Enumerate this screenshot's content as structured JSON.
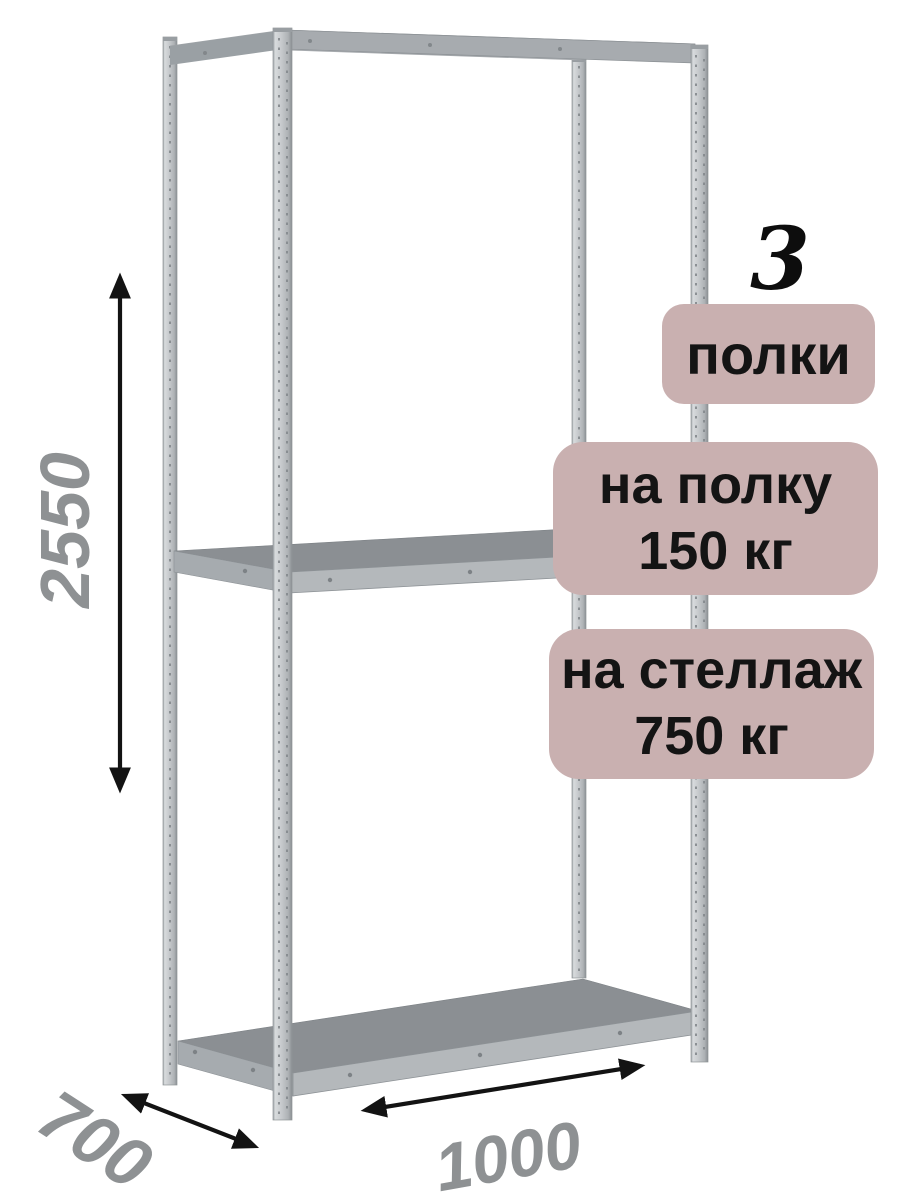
{
  "product": {
    "description": "metal-boltless-shelving-rack",
    "shelves_shown": 3
  },
  "badges": {
    "shelf_count": {
      "number": "3",
      "label": "полки"
    },
    "per_shelf": {
      "line1": "на полку",
      "line2": "150 кг"
    },
    "per_rack": {
      "line1": "на стеллаж",
      "line2": "750 кг"
    }
  },
  "dimensions": {
    "height_mm": "2550",
    "depth_mm": "700",
    "width_mm": "1000"
  },
  "colors": {
    "badge_bg": "#c9b0b0",
    "badge_text": "#141414",
    "dimension_text": "#8e9193",
    "arrow": "#131313",
    "metal_light": "#c6c9cc",
    "metal_mid": "#a7abaf",
    "shelf_top": "#8b8f93",
    "shelf_edge": "#b4b8bb",
    "background": "#ffffff"
  }
}
